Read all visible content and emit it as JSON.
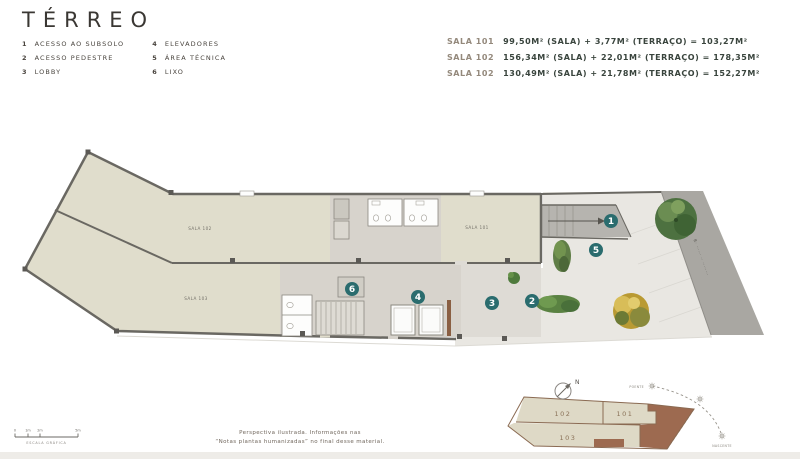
{
  "title": "TÉRREO",
  "legend": {
    "items": [
      {
        "num": "1",
        "label": "ACESSO AO SUBSOLO"
      },
      {
        "num": "2",
        "label": "ACESSO PEDESTRE"
      },
      {
        "num": "3",
        "label": "LOBBY"
      },
      {
        "num": "4",
        "label": "ELEVADORES"
      },
      {
        "num": "5",
        "label": "ÁREA TÉCNICA"
      },
      {
        "num": "6",
        "label": "LIXO"
      }
    ]
  },
  "areas": {
    "rows": [
      {
        "unit": "SALA 101",
        "detail": "99,50M² (SALA) + 3,77M² (TERRAÇO) = 103,27M²"
      },
      {
        "unit": "SALA 102",
        "detail": "156,34M² (SALA) + 22,01M² (TERRAÇO) = 178,35M²"
      },
      {
        "unit": "SALA 102",
        "detail": "130,49M² (SALA) + 21,78M² (TERRAÇO) = 152,27M²"
      }
    ]
  },
  "plan": {
    "rooms": {
      "sala102": "SALA 102",
      "sala103": "SALA 103",
      "sala101": "SALA 101"
    },
    "markers": [
      {
        "label": "1"
      },
      {
        "label": "2"
      },
      {
        "label": "3"
      },
      {
        "label": "4"
      },
      {
        "label": "5"
      },
      {
        "label": "6"
      }
    ],
    "street_label": "R· ······ ·· ········"
  },
  "keyplan": {
    "units": [
      "102",
      "101",
      "103"
    ],
    "north": "N",
    "sun": {
      "west": "POENTE",
      "east": "NASCENTE"
    }
  },
  "scalebar": {
    "ticks": [
      "0",
      "1m",
      "2m",
      "5m"
    ],
    "caption": "ESCALA GRÁFICA"
  },
  "disclaimer": {
    "line1": "Perspectiva ilustrada. Informações nas",
    "line2": "“Notas plantas humanizadas” no final desse material."
  },
  "colors": {
    "badge_teal": "#2a6c6e",
    "room_beige": "#e0ddcc",
    "core_gray": "#d7d3cc",
    "street_gray": "#a9a7a2",
    "keyplan_brown": "#9d6a50",
    "value_text": "#39443d"
  }
}
